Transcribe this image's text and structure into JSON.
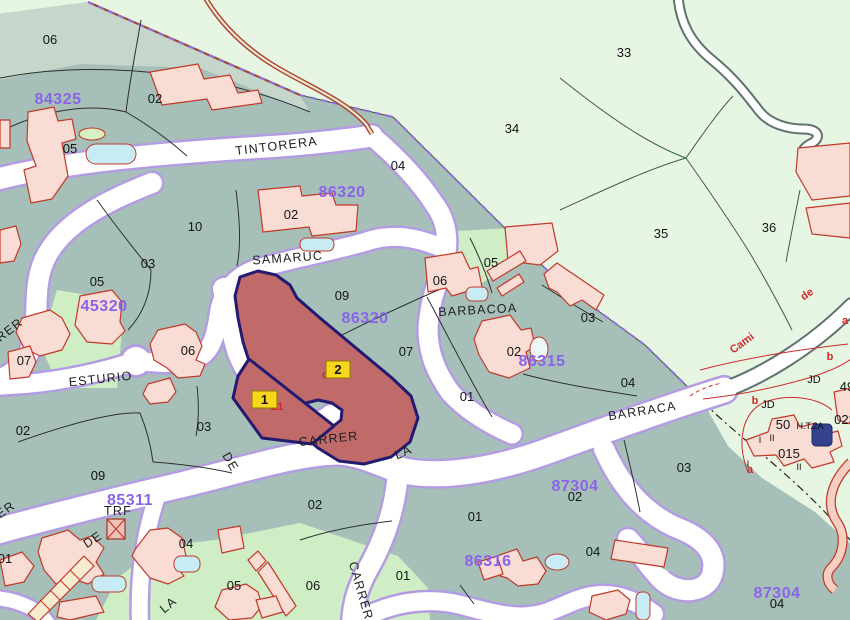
{
  "map": {
    "title": "Cadastral parcel map",
    "colors": {
      "urban": "#a6c0b9",
      "rural": "#e7f6e2",
      "strip": "#c4d7ca",
      "light_parcel": "#cfeec5",
      "road_fill": "#ffffff",
      "road_casing": "#b49ce2",
      "path_casing": "#5f7270",
      "building_fill": "#f9dcd3",
      "building_stroke": "#c0392b",
      "pool": "#c8ecf4",
      "dark_pool": "#33418f",
      "highlight_fill": "#c06a6a",
      "highlight_stroke": "#241a70",
      "parcel_line": "#2f2f2f",
      "rural_line": "#39604a",
      "boundary_dash": "#8f6fe0",
      "trail": "#a8432e",
      "num": "#141414",
      "code": "#8a64e8",
      "street": "#1f1f1f",
      "red": "#cc2a2a",
      "jd": "#111111",
      "label_box": "#f8d61b",
      "label_box_border": "#8a7c00"
    },
    "labels": [
      {
        "text": "06",
        "x": 50,
        "y": 44,
        "kind": "n"
      },
      {
        "text": "02",
        "x": 155,
        "y": 103,
        "kind": "n"
      },
      {
        "text": "05",
        "x": 70,
        "y": 153,
        "kind": "n"
      },
      {
        "text": "04",
        "x": 398,
        "y": 170,
        "kind": "n"
      },
      {
        "text": "02",
        "x": 291,
        "y": 219,
        "kind": "n"
      },
      {
        "text": "10",
        "x": 195,
        "y": 231,
        "kind": "n"
      },
      {
        "text": "33",
        "x": 624,
        "y": 57,
        "kind": "n"
      },
      {
        "text": "34",
        "x": 512,
        "y": 133,
        "kind": "n"
      },
      {
        "text": "35",
        "x": 661,
        "y": 238,
        "kind": "n"
      },
      {
        "text": "36",
        "x": 769,
        "y": 232,
        "kind": "n"
      },
      {
        "text": "03",
        "x": 148,
        "y": 268,
        "kind": "n"
      },
      {
        "text": "05",
        "x": 97,
        "y": 286,
        "kind": "n"
      },
      {
        "text": "09",
        "x": 342,
        "y": 300,
        "kind": "n"
      },
      {
        "text": "05",
        "x": 491,
        "y": 267,
        "kind": "n"
      },
      {
        "text": "06",
        "x": 440,
        "y": 285,
        "kind": "n"
      },
      {
        "text": "03",
        "x": 588,
        "y": 322,
        "kind": "n"
      },
      {
        "text": "02",
        "x": 514,
        "y": 356,
        "kind": "n"
      },
      {
        "text": "07",
        "x": 406,
        "y": 356,
        "kind": "n"
      },
      {
        "text": "06",
        "x": 188,
        "y": 355,
        "kind": "n"
      },
      {
        "text": "07",
        "x": 24,
        "y": 365,
        "kind": "n"
      },
      {
        "text": "04",
        "x": 628,
        "y": 387,
        "kind": "n"
      },
      {
        "text": "01",
        "x": 467,
        "y": 401,
        "kind": "n"
      },
      {
        "text": "03",
        "x": 204,
        "y": 431,
        "kind": "n"
      },
      {
        "text": "02",
        "x": 23,
        "y": 435,
        "kind": "n"
      },
      {
        "text": "09",
        "x": 98,
        "y": 480,
        "kind": "n"
      },
      {
        "text": "04",
        "x": 186,
        "y": 548,
        "kind": "n"
      },
      {
        "text": "05",
        "x": 234,
        "y": 590,
        "kind": "n"
      },
      {
        "text": "06",
        "x": 313,
        "y": 590,
        "kind": "n"
      },
      {
        "text": "01",
        "x": 403,
        "y": 580,
        "kind": "n"
      },
      {
        "text": "01",
        "x": 475,
        "y": 521,
        "kind": "n"
      },
      {
        "text": "02",
        "x": 315,
        "y": 509,
        "kind": "n"
      },
      {
        "text": "03",
        "x": 684,
        "y": 472,
        "kind": "n"
      },
      {
        "text": "02",
        "x": 575,
        "y": 501,
        "kind": "n"
      },
      {
        "text": "04",
        "x": 593,
        "y": 556,
        "kind": "n"
      },
      {
        "text": "04",
        "x": 777,
        "y": 608,
        "kind": "n"
      },
      {
        "text": "01",
        "x": 5,
        "y": 563,
        "kind": "n"
      },
      {
        "text": "015",
        "x": 789,
        "y": 458,
        "kind": "n"
      },
      {
        "text": "50",
        "x": 783,
        "y": 429,
        "kind": "n"
      },
      {
        "text": "023",
        "x": 845,
        "y": 424,
        "kind": "n"
      },
      {
        "text": "49",
        "x": 847,
        "y": 391,
        "kind": "n"
      },
      {
        "text": "84325",
        "x": 58,
        "y": 104,
        "kind": "c"
      },
      {
        "text": "86320",
        "x": 342,
        "y": 197,
        "kind": "c"
      },
      {
        "text": "86320",
        "x": 365,
        "y": 323,
        "kind": "c"
      },
      {
        "text": "45320",
        "x": 104,
        "y": 311,
        "kind": "c"
      },
      {
        "text": "86315",
        "x": 542,
        "y": 366,
        "kind": "c"
      },
      {
        "text": "85311",
        "x": 130,
        "y": 505,
        "kind": "c"
      },
      {
        "text": "87304",
        "x": 575,
        "y": 491,
        "kind": "c"
      },
      {
        "text": "86316",
        "x": 488,
        "y": 566,
        "kind": "c"
      },
      {
        "text": "87304",
        "x": 777,
        "y": 598,
        "kind": "c"
      },
      {
        "text": "TINTORERA",
        "x": 277,
        "y": 150,
        "kind": "s",
        "rot": -7
      },
      {
        "text": "SAMARUC",
        "x": 288,
        "y": 262,
        "kind": "s",
        "rot": -4
      },
      {
        "text": "ESTURIO",
        "x": 101,
        "y": 383,
        "kind": "s",
        "rot": -6
      },
      {
        "text": "BARBACOA",
        "x": 478,
        "y": 314,
        "kind": "s",
        "rot": -3
      },
      {
        "text": "BARRACA",
        "x": 643,
        "y": 415,
        "kind": "s",
        "rot": -9
      },
      {
        "text": "CARRER",
        "x": 329,
        "y": 443,
        "kind": "s",
        "rot": -6
      },
      {
        "text": "LA",
        "x": 405,
        "y": 456,
        "kind": "s",
        "rot": -24
      },
      {
        "text": "DE",
        "x": 227,
        "y": 464,
        "kind": "s",
        "rot": 60
      },
      {
        "text": "CARRER",
        "x": 357,
        "y": 592,
        "kind": "s",
        "rot": 74
      },
      {
        "text": "LA",
        "x": 171,
        "y": 608,
        "kind": "s",
        "rot": -40
      },
      {
        "text": "DE",
        "x": 95,
        "y": 543,
        "kind": "s",
        "rot": -33
      },
      {
        "text": "ER",
        "x": 8,
        "y": 513,
        "kind": "s",
        "rot": -36
      },
      {
        "text": "RER",
        "x": 12,
        "y": 333,
        "kind": "s",
        "rot": -38
      },
      {
        "text": "TRF",
        "x": 118,
        "y": 515,
        "kind": "s",
        "size": 10
      },
      {
        "text": "Cami",
        "x": 744,
        "y": 346,
        "kind": "r",
        "rot": -36
      },
      {
        "text": "de",
        "x": 809,
        "y": 297,
        "kind": "r",
        "rot": -36
      },
      {
        "text": "a",
        "x": 845,
        "y": 324,
        "kind": "r"
      },
      {
        "text": "b",
        "x": 830,
        "y": 360,
        "kind": "r"
      },
      {
        "text": "b",
        "x": 755,
        "y": 404,
        "kind": "r"
      },
      {
        "text": "a",
        "x": 750,
        "y": 473,
        "kind": "r"
      },
      {
        "text": "c",
        "x": 325,
        "y": 378,
        "kind": "r"
      },
      {
        "text": "L1",
        "x": 277,
        "y": 410,
        "kind": "r"
      },
      {
        "text": "JD",
        "x": 814,
        "y": 383,
        "kind": "j"
      },
      {
        "text": "JD",
        "x": 768,
        "y": 408,
        "kind": "j"
      },
      {
        "text": "H.T.2A",
        "x": 810,
        "y": 429,
        "kind": "t"
      },
      {
        "text": "I",
        "x": 760,
        "y": 443,
        "kind": "t"
      },
      {
        "text": "II",
        "x": 772,
        "y": 441,
        "kind": "t"
      },
      {
        "text": "II",
        "x": 799,
        "y": 470,
        "kind": "t"
      },
      {
        "text": "I",
        "x": 748,
        "y": 467,
        "kind": "t"
      }
    ],
    "highlight_boxes": [
      {
        "label": "1",
        "x": 252,
        "y": 391,
        "w": 25,
        "h": 17
      },
      {
        "label": "2",
        "x": 326,
        "y": 361,
        "w": 24,
        "h": 17
      }
    ]
  }
}
